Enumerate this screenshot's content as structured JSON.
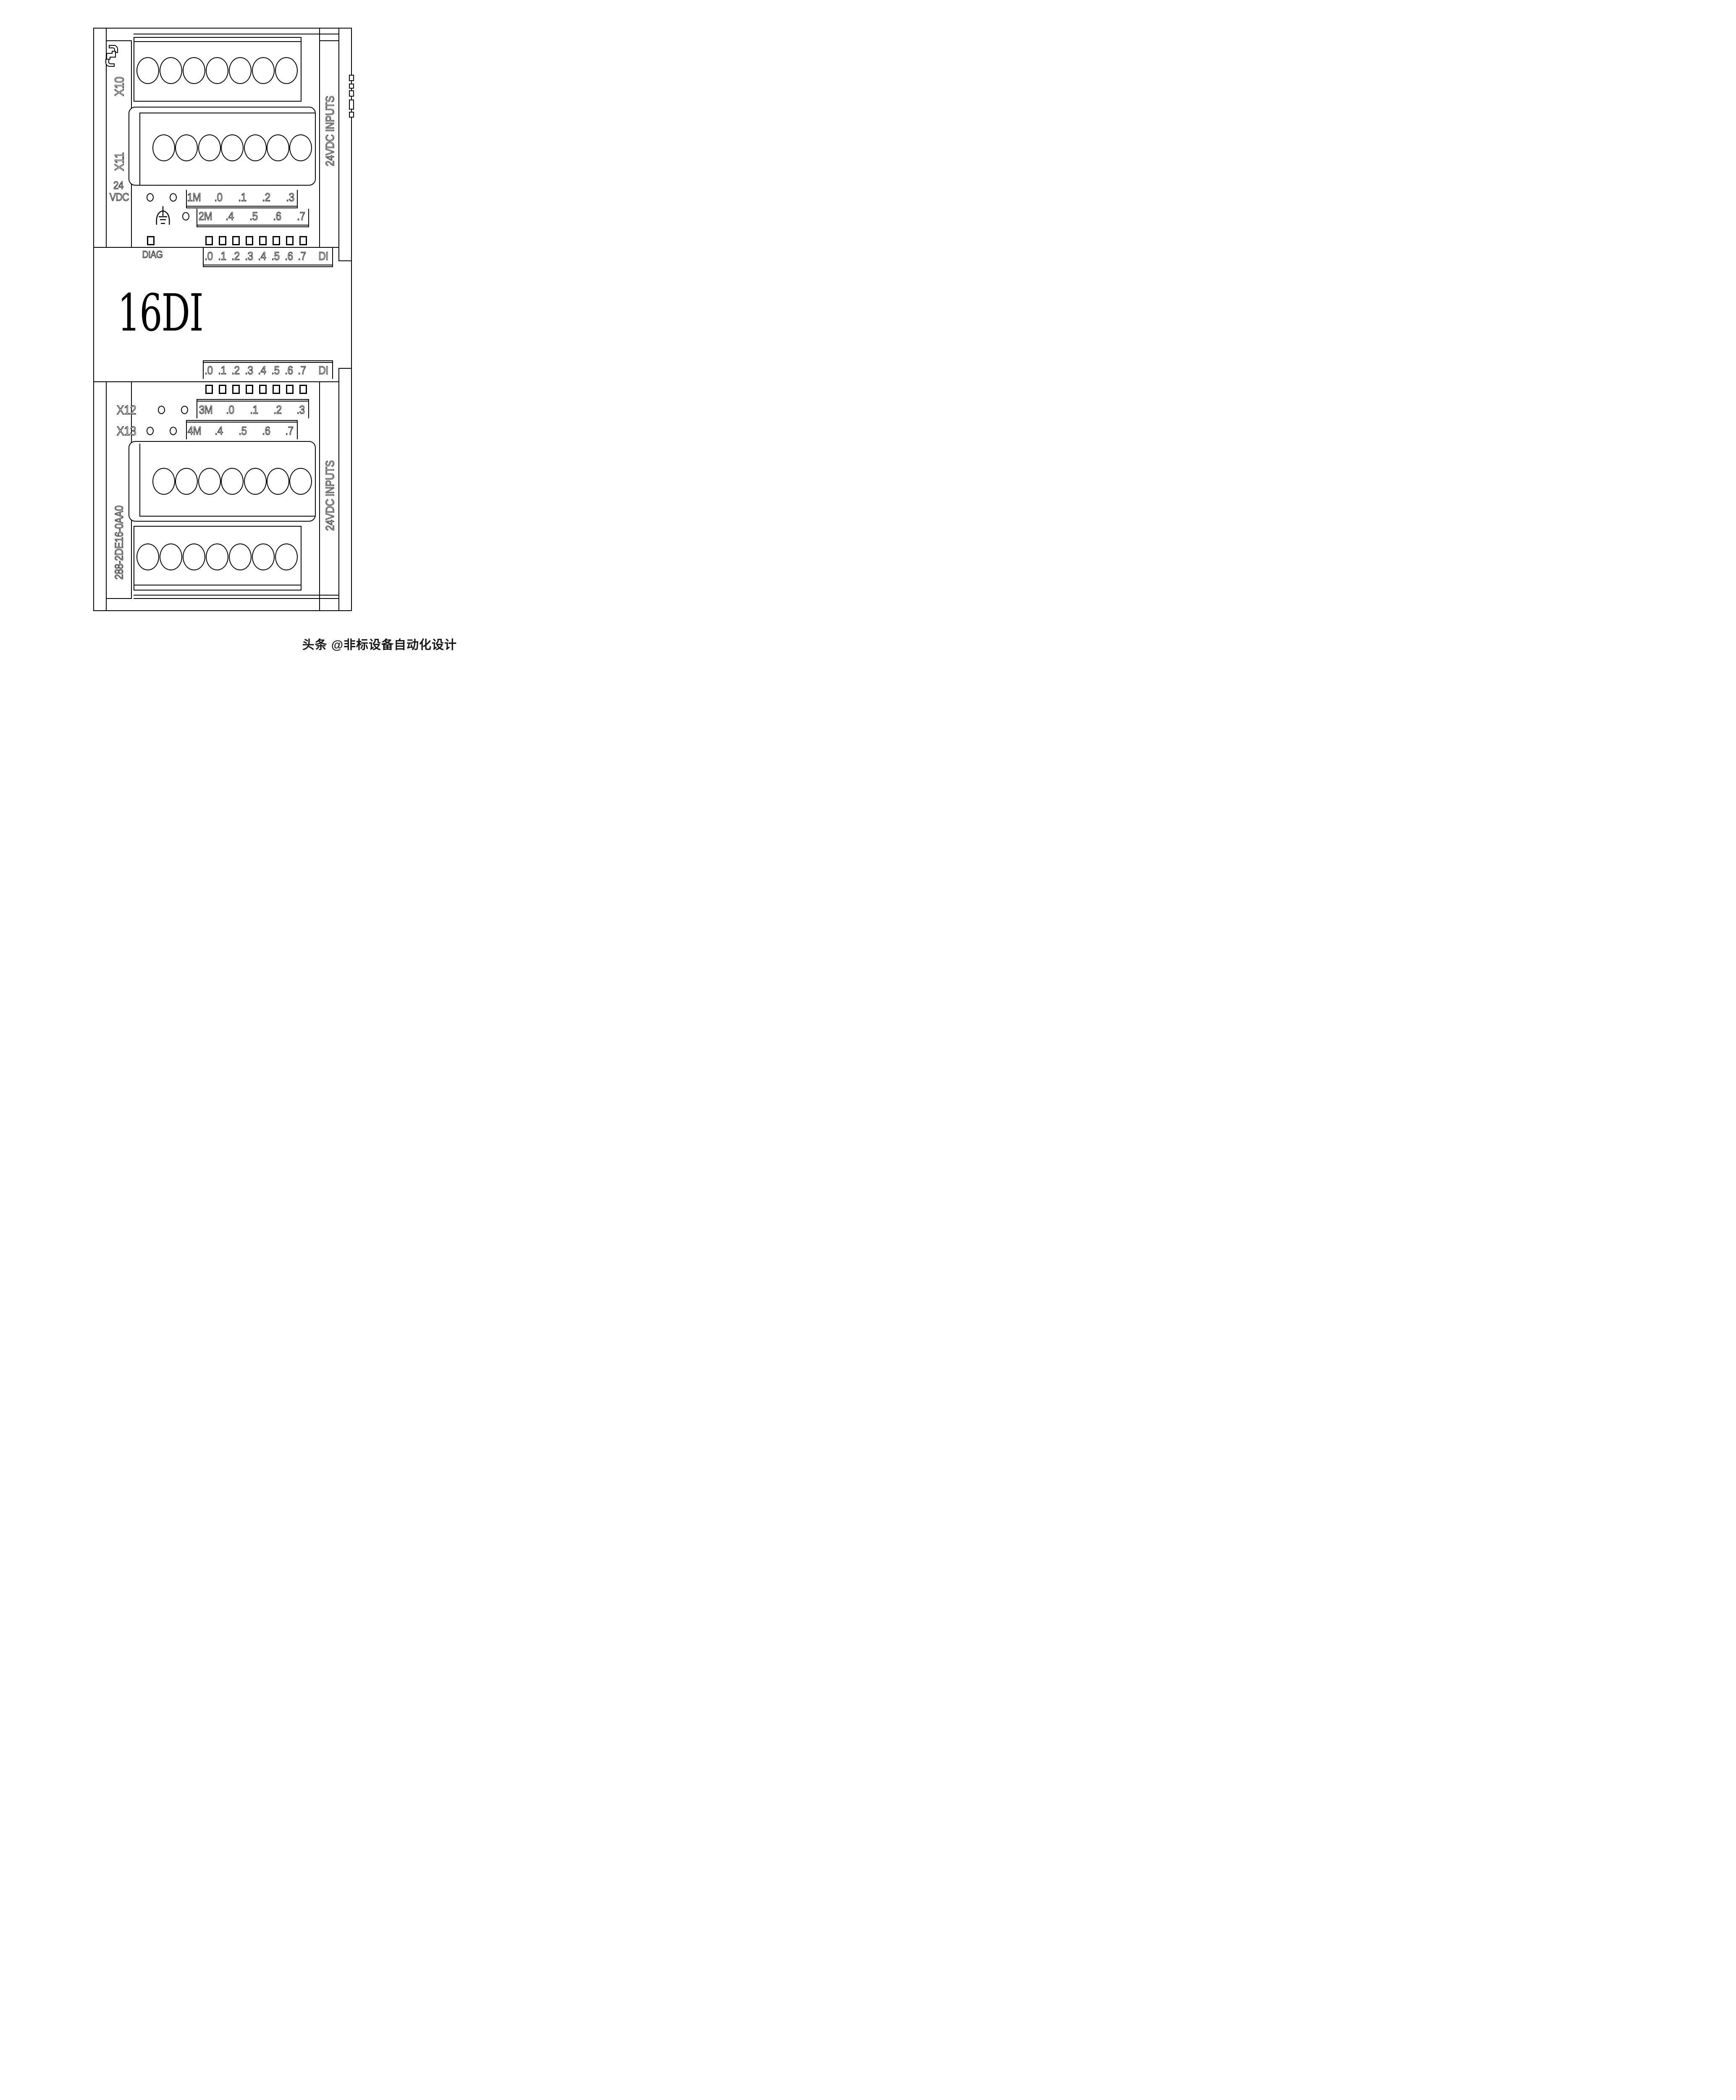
{
  "module": {
    "product_type": "16DI",
    "order_number": "288-2DE16-0AA0",
    "diag_label": "DIAG",
    "power": {
      "line1": "24",
      "line2": "VDC"
    },
    "side_labels": {
      "top": "24VDC INPUTS",
      "bottom": "24VDC INPUTS"
    }
  },
  "connectors": {
    "x10": {
      "label": "X10",
      "terminal_count": 7
    },
    "x11": {
      "label": "X11",
      "terminal_count": 7
    },
    "x12": {
      "label": "X12",
      "terminal_count": 7
    },
    "x13": {
      "label": "X13",
      "terminal_count": 7
    }
  },
  "terminal_rows": {
    "row1": {
      "labels": [
        "1M",
        ".0",
        ".1",
        ".2",
        ".3"
      ]
    },
    "row2": {
      "labels": [
        "2M",
        ".4",
        ".5",
        ".6",
        ".7"
      ]
    },
    "row3": {
      "labels": [
        "3M",
        ".0",
        ".1",
        ".2",
        ".3"
      ]
    },
    "row4": {
      "labels": [
        "4M",
        ".4",
        ".5",
        ".6",
        ".7"
      ]
    }
  },
  "led_rows": {
    "top": {
      "channel_labels": [
        ".0",
        ".1",
        ".2",
        ".3",
        ".4",
        ".5",
        ".6",
        ".7"
      ],
      "group_label": "DI",
      "led_count": 8,
      "has_diag_led": true
    },
    "bottom": {
      "channel_labels": [
        ".0",
        ".1",
        ".2",
        ".3",
        ".4",
        ".5",
        ".6",
        ".7"
      ],
      "group_label": "DI",
      "led_count": 8
    }
  },
  "icons": {
    "clip": "terminal-block-removal-icon",
    "ground": "functional-earth-icon"
  },
  "watermark": {
    "text": "头条 @非标设备自动化设计"
  }
}
